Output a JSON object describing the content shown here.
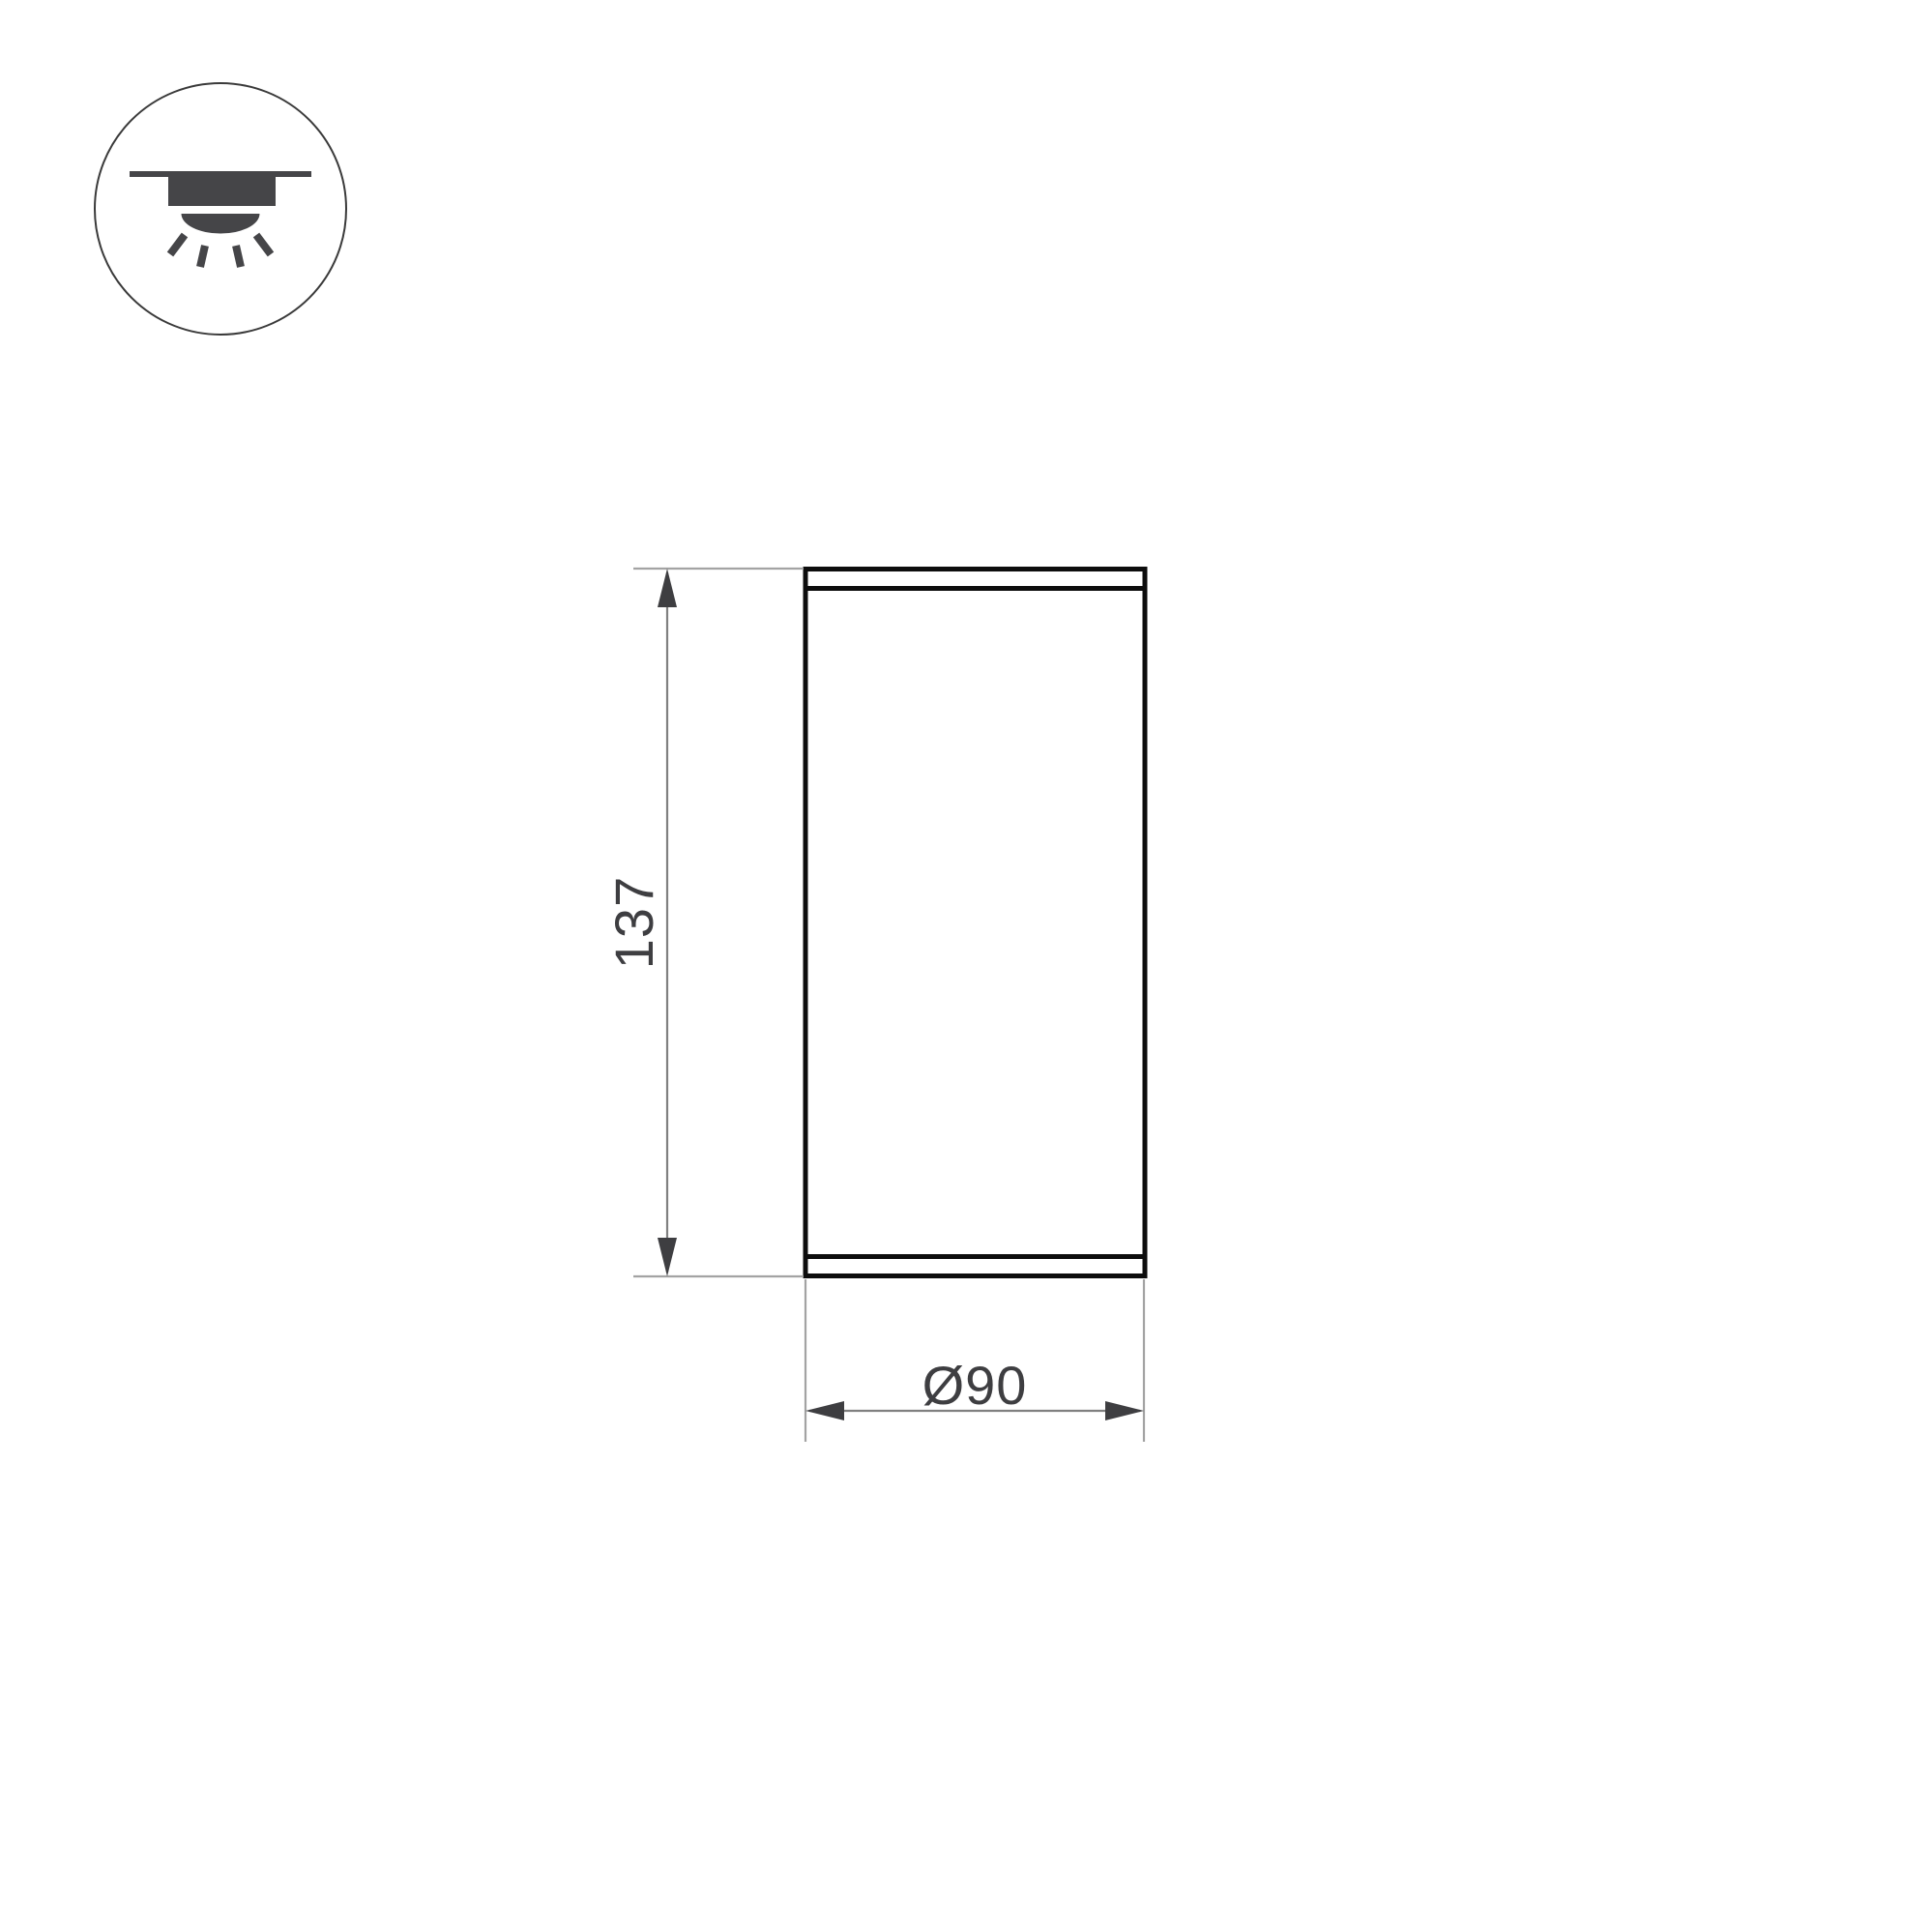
{
  "drawing": {
    "type": "technical-dimension-drawing",
    "view": "front-elevation-of-cylindrical-ceiling-luminaire",
    "dimensions": {
      "height": {
        "label": "137"
      },
      "diameter": {
        "label": "Ø90"
      }
    }
  },
  "icon": {
    "name": "surface-mounted-ceiling-downlight-icon"
  },
  "colors": {
    "outline": "#0d0d0d",
    "dimension_line": "#808080",
    "extension_line": "#a3a3a3",
    "annotation": "#3e3e41",
    "icon_fill": "#454548",
    "icon_ring": "#3a3a3a",
    "page_bg": "#ffffff"
  }
}
